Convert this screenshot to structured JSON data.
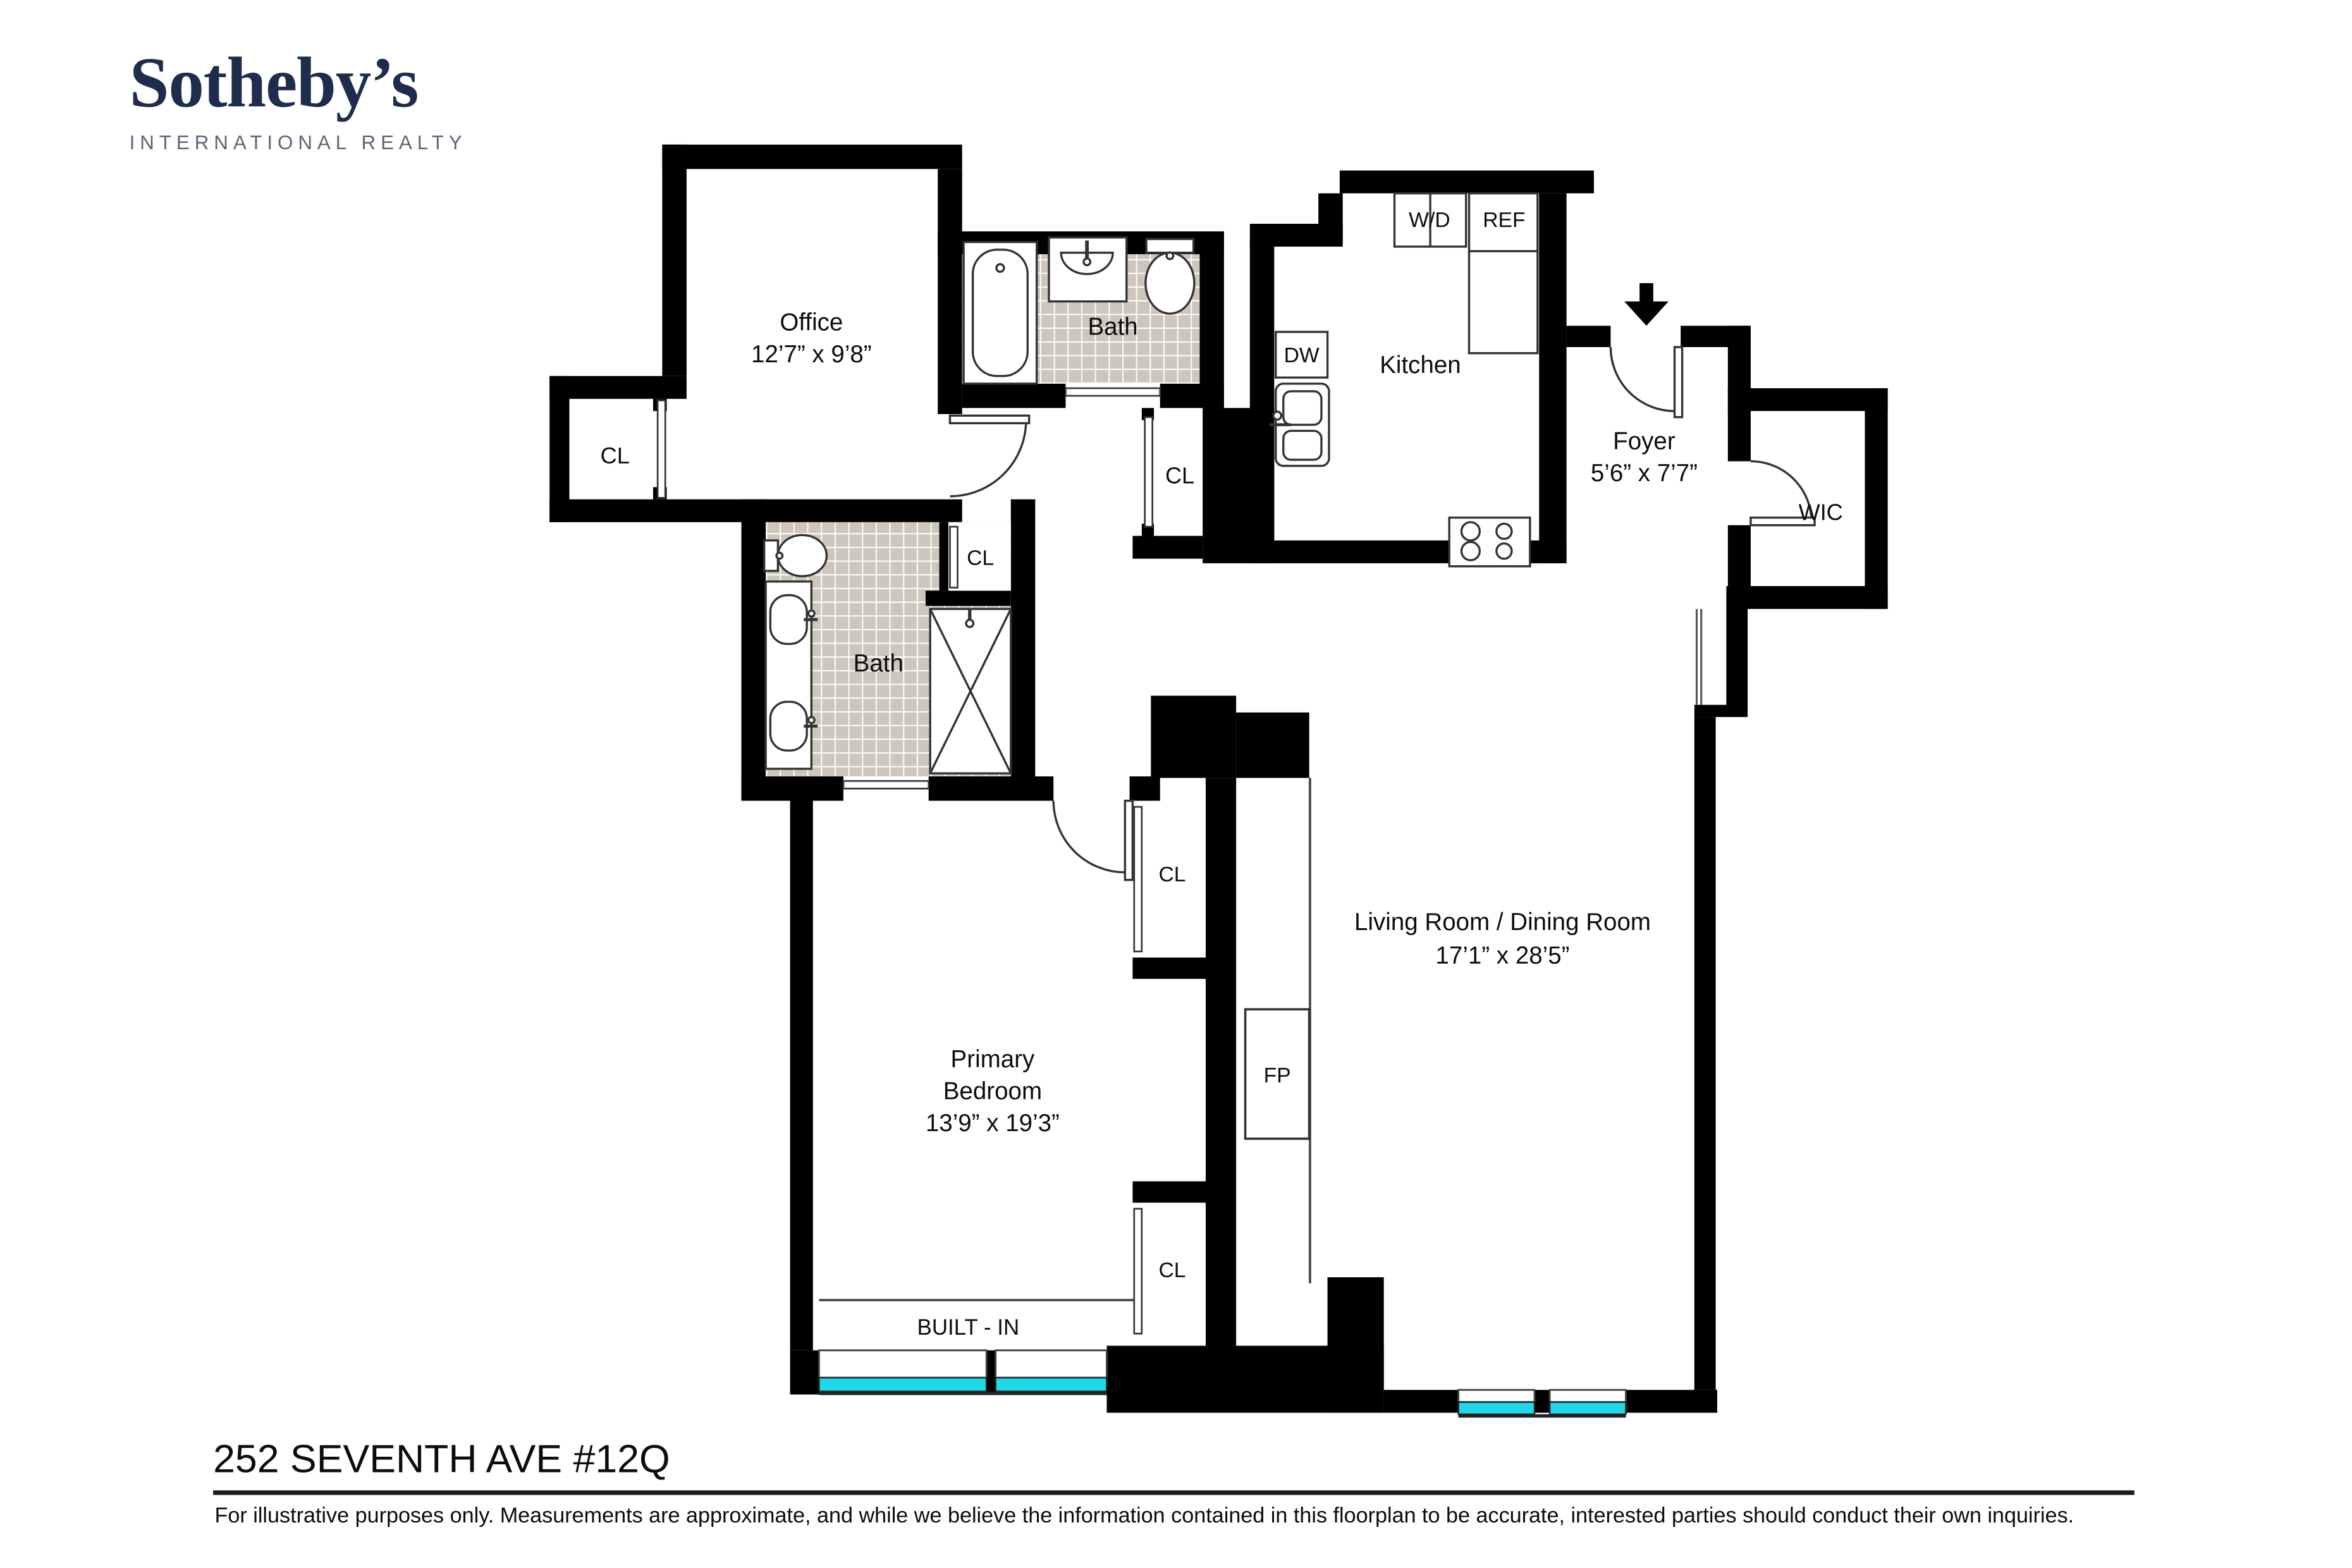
{
  "brand": {
    "name": "Sotheby’s",
    "tagline": "INTERNATIONAL REALTY"
  },
  "rooms": {
    "office": {
      "name": "Office",
      "dims": "12’7” x 9’8”"
    },
    "bath_top": {
      "name": "Bath"
    },
    "kitchen": {
      "name": "Kitchen"
    },
    "foyer": {
      "name": "Foyer",
      "dims": "5’6” x 7’7”"
    },
    "wic": {
      "name": "WIC"
    },
    "bath_primary": {
      "name": "Bath"
    },
    "primary_bedroom": {
      "line1": "Primary",
      "line2": "Bedroom",
      "dims": "13’9” x 19’3”"
    },
    "living": {
      "name": "Living Room / Dining Room",
      "dims": "17’1” x 28’5”"
    }
  },
  "features": {
    "closet": "CL",
    "washer_dryer": "W/D",
    "refrigerator": "REF",
    "dishwasher": "DW",
    "fireplace": "FP",
    "built_in": "BUILT - IN"
  },
  "footer": {
    "title": "252 SEVENTH AVE #12Q",
    "disclaimer": "For illustrative purposes only. Measurements are approximate, and while we believe the information contained in this floorplan to be accurate, interested parties should conduct their own inquiries."
  },
  "colors": {
    "wall": "#000000",
    "window_glass": "#1fd8e9",
    "tile": "#cdc6bb",
    "brand_navy": "#1e2c4e",
    "brand_gray": "#5a6577"
  }
}
